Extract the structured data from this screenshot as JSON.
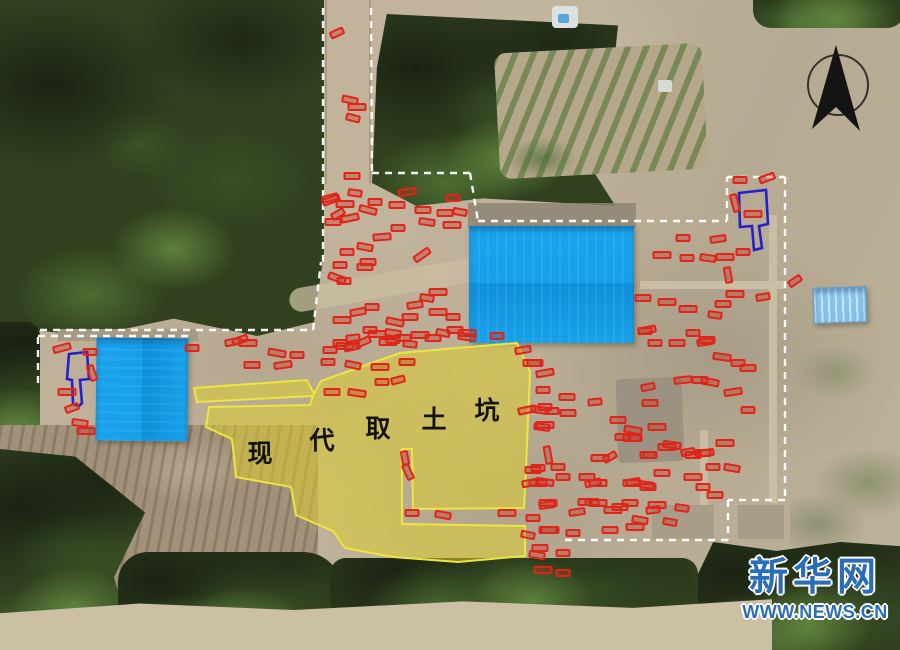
{
  "site": {
    "soil_pit_label": {
      "characters": [
        "现",
        "代",
        "取",
        "土",
        "坑"
      ],
      "positions": [
        [
          260,
          452
        ],
        [
          322,
          439
        ],
        [
          378,
          427
        ],
        [
          434,
          418
        ],
        [
          487,
          409
        ]
      ]
    },
    "pit_overlay": {
      "fill": "rgba(222,208,44,0.52)",
      "stroke": "#ece73f",
      "paths": [
        "M194,388 L307,380 L314,394 L321,381 L383,359 L400,353 L457,348 L517,343 L530,372 L526,468 L524,508 L413,509 L412,449 L402,449 L402,524 L525,526 L525,556 L458,562 L393,557 L345,548 L333,531 L296,515 L291,487 L236,477 L232,439 L206,427 L209,407 L310,405 L313,396 L197,402 Z"
      ]
    },
    "ramp_tombs": {
      "stroke": "#2420d0",
      "paths": [
        "M69,354 L87,352 L89,379 L80,380 L82,403 L79,406 L73,404 L72,380 L67,379 Z",
        "M739,193 L766,190 L768,224 L759,226 L762,248 L754,250 L752,226 L740,227 Z"
      ]
    },
    "boundaries": {
      "stroke": "#ffffff",
      "dash": "7 6",
      "segments": [
        [
          [
            323,
            8
          ],
          [
            323,
            262
          ]
        ],
        [
          [
            371,
            8
          ],
          [
            372,
            173
          ]
        ],
        [
          [
            372,
            173
          ],
          [
            470,
            173
          ]
        ],
        [
          [
            470,
            173
          ],
          [
            478,
            221
          ]
        ],
        [
          [
            478,
            221
          ],
          [
            727,
            221
          ]
        ],
        [
          [
            727,
            221
          ],
          [
            727,
            177
          ]
        ],
        [
          [
            727,
            177
          ],
          [
            785,
            177
          ]
        ],
        [
          [
            785,
            177
          ],
          [
            785,
            500
          ]
        ],
        [
          [
            785,
            500
          ],
          [
            728,
            500
          ]
        ],
        [
          [
            728,
            500
          ],
          [
            728,
            540
          ]
        ],
        [
          [
            728,
            540
          ],
          [
            560,
            540
          ]
        ],
        [
          [
            40,
            330
          ],
          [
            313,
            330
          ]
        ],
        [
          [
            313,
            330
          ],
          [
            321,
            262
          ]
        ],
        [
          [
            38,
            336
          ],
          [
            190,
            336
          ]
        ],
        [
          [
            38,
            337
          ],
          [
            38,
            385
          ]
        ]
      ]
    },
    "compass": {
      "circle": [
        838,
        85,
        30
      ],
      "arrow": "836,45 860,131 836,107 812,129",
      "color": "#141414"
    },
    "tomb_markers": {
      "color": "#e2231a",
      "default_w": 17,
      "default_h": 8,
      "items": [
        [
          337,
          33,
          -25
        ],
        [
          350,
          100,
          12
        ],
        [
          357,
          107,
          0
        ],
        [
          353,
          118,
          14
        ],
        [
          352,
          176,
          0
        ],
        [
          331,
          200,
          -20
        ],
        [
          355,
          193,
          8
        ],
        [
          330,
          198,
          -15
        ],
        [
          345,
          204,
          0
        ],
        [
          375,
          202,
          0
        ],
        [
          397,
          205,
          0
        ],
        [
          407,
          192,
          -10
        ],
        [
          453,
          198,
          0
        ],
        [
          423,
          210,
          0
        ],
        [
          368,
          210,
          15
        ],
        [
          338,
          214,
          -30
        ],
        [
          333,
          222,
          0
        ],
        [
          350,
          218,
          -12
        ],
        [
          398,
          228,
          0
        ],
        [
          427,
          222,
          8
        ],
        [
          452,
          225,
          0
        ],
        [
          460,
          212,
          10
        ],
        [
          445,
          213,
          0
        ],
        [
          382,
          237,
          -5
        ],
        [
          347,
          252,
          0
        ],
        [
          365,
          247,
          10
        ],
        [
          422,
          255,
          -35
        ],
        [
          340,
          265,
          0
        ],
        [
          368,
          262,
          0
        ],
        [
          337,
          278,
          20
        ],
        [
          344,
          281,
          0
        ],
        [
          365,
          267,
          0
        ],
        [
          438,
          292,
          0
        ],
        [
          427,
          298,
          10
        ],
        [
          415,
          305,
          -8
        ],
        [
          438,
          312,
          0
        ],
        [
          453,
          317,
          0
        ],
        [
          410,
          317,
          0
        ],
        [
          395,
          322,
          12
        ],
        [
          372,
          307,
          0
        ],
        [
          358,
          312,
          -10
        ],
        [
          342,
          320,
          0
        ],
        [
          370,
          330,
          0
        ],
        [
          393,
          333,
          8
        ],
        [
          377,
          334,
          0
        ],
        [
          353,
          338,
          -6
        ],
        [
          403,
          338,
          0
        ],
        [
          420,
          335,
          0
        ],
        [
          443,
          333,
          10
        ],
        [
          455,
          330,
          0
        ],
        [
          467,
          333,
          0
        ],
        [
          340,
          343,
          0
        ],
        [
          352,
          347,
          -12
        ],
        [
          388,
          342,
          0
        ],
        [
          410,
          344,
          6
        ],
        [
          240,
          340,
          -18
        ],
        [
          277,
          353,
          10
        ],
        [
          297,
          355,
          0
        ],
        [
          252,
          365,
          0
        ],
        [
          283,
          365,
          -8
        ],
        [
          330,
          350,
          0
        ],
        [
          363,
          342,
          -25
        ],
        [
          345,
          346,
          0
        ],
        [
          393,
          340,
          0
        ],
        [
          433,
          338,
          0
        ],
        [
          467,
          337,
          8
        ],
        [
          497,
          336,
          0
        ],
        [
          523,
          350,
          -10
        ],
        [
          532,
          363,
          0
        ],
        [
          328,
          362,
          0
        ],
        [
          353,
          365,
          12
        ],
        [
          380,
          367,
          0
        ],
        [
          398,
          380,
          -15
        ],
        [
          332,
          392,
          0
        ],
        [
          357,
          393,
          8
        ],
        [
          382,
          382,
          0
        ],
        [
          407,
          362,
          0
        ],
        [
          62,
          348,
          -15
        ],
        [
          90,
          352,
          0
        ],
        [
          92,
          373,
          70
        ],
        [
          67,
          392,
          0
        ],
        [
          72,
          408,
          -20
        ],
        [
          80,
          423,
          8
        ],
        [
          86,
          431,
          0
        ],
        [
          192,
          348,
          0
        ],
        [
          233,
          342,
          -10
        ],
        [
          248,
          343,
          0
        ],
        [
          405,
          458,
          80
        ],
        [
          408,
          472,
          65
        ],
        [
          527,
          410,
          -12
        ],
        [
          545,
          407,
          0
        ],
        [
          542,
          427,
          8
        ],
        [
          548,
          455,
          80
        ],
        [
          538,
          468,
          0
        ],
        [
          530,
          483,
          -10
        ],
        [
          548,
          503,
          0
        ],
        [
          528,
          535,
          12
        ],
        [
          540,
          548,
          0
        ],
        [
          550,
          530,
          0
        ],
        [
          412,
          513,
          0
        ],
        [
          443,
          515,
          10
        ],
        [
          507,
          513,
          0
        ],
        [
          533,
          518,
          0
        ],
        [
          547,
          505,
          -8
        ],
        [
          538,
          483,
          0
        ],
        [
          563,
          553,
          0
        ],
        [
          537,
          555,
          10
        ],
        [
          543,
          570,
          0
        ],
        [
          563,
          573,
          0
        ],
        [
          593,
          483,
          -12
        ],
        [
          598,
          503,
          0
        ],
        [
          585,
          502,
          0
        ],
        [
          535,
          363,
          0
        ],
        [
          545,
          373,
          -10
        ],
        [
          543,
          390,
          0
        ],
        [
          567,
          397,
          0
        ],
        [
          540,
          410,
          8
        ],
        [
          552,
          411,
          0
        ],
        [
          568,
          413,
          0
        ],
        [
          545,
          425,
          0
        ],
        [
          595,
          402,
          -6
        ],
        [
          618,
          420,
          0
        ],
        [
          633,
          430,
          10
        ],
        [
          635,
          438,
          0
        ],
        [
          623,
          437,
          0
        ],
        [
          657,
          427,
          0
        ],
        [
          648,
          387,
          -12
        ],
        [
          650,
          403,
          0
        ],
        [
          672,
          445,
          8
        ],
        [
          650,
          455,
          0
        ],
        [
          693,
          455,
          0
        ],
        [
          705,
          453,
          -8
        ],
        [
          713,
          467,
          0
        ],
        [
          732,
          468,
          10
        ],
        [
          693,
          477,
          0
        ],
        [
          703,
          487,
          0
        ],
        [
          715,
          495,
          0
        ],
        [
          647,
          330,
          -10
        ],
        [
          693,
          333,
          0
        ],
        [
          707,
          340,
          0
        ],
        [
          722,
          357,
          8
        ],
        [
          738,
          363,
          0
        ],
        [
          748,
          368,
          0
        ],
        [
          733,
          392,
          -8
        ],
        [
          748,
          410,
          0
        ],
        [
          700,
          380,
          0
        ],
        [
          710,
          382,
          10
        ],
        [
          655,
          343,
          0
        ],
        [
          677,
          343,
          0
        ],
        [
          683,
          380,
          -6
        ],
        [
          558,
          467,
          0
        ],
        [
          533,
          470,
          0
        ],
        [
          545,
          482,
          8
        ],
        [
          563,
          477,
          0
        ],
        [
          587,
          477,
          0
        ],
        [
          598,
          483,
          0
        ],
        [
          633,
          482,
          -10
        ],
        [
          648,
          487,
          0
        ],
        [
          657,
          505,
          0
        ],
        [
          682,
          508,
          8
        ],
        [
          630,
          503,
          0
        ],
        [
          613,
          510,
          0
        ],
        [
          592,
          502,
          0
        ],
        [
          577,
          512,
          -8
        ],
        [
          548,
          530,
          0
        ],
        [
          573,
          533,
          0
        ],
        [
          640,
          520,
          10
        ],
        [
          600,
          458,
          0
        ],
        [
          610,
          457,
          -30
        ],
        [
          648,
          455,
          0
        ],
        [
          632,
          483,
          0
        ],
        [
          647,
          485,
          8
        ],
        [
          662,
          473,
          0
        ],
        [
          667,
          447,
          0
        ],
        [
          688,
          452,
          -10
        ],
        [
          703,
          453,
          0
        ],
        [
          725,
          443,
          0
        ],
        [
          653,
          510,
          -8
        ],
        [
          620,
          507,
          0
        ],
        [
          635,
          527,
          0
        ],
        [
          670,
          522,
          10
        ],
        [
          610,
          530,
          0
        ],
        [
          632,
          438,
          0
        ],
        [
          683,
          238,
          0
        ],
        [
          718,
          239,
          -8
        ],
        [
          662,
          255,
          0
        ],
        [
          687,
          258,
          0
        ],
        [
          708,
          258,
          8
        ],
        [
          725,
          257,
          0
        ],
        [
          743,
          252,
          0
        ],
        [
          728,
          275,
          80
        ],
        [
          735,
          294,
          0
        ],
        [
          763,
          297,
          -10
        ],
        [
          723,
          304,
          0
        ],
        [
          688,
          309,
          0
        ],
        [
          715,
          315,
          8
        ],
        [
          643,
          298,
          0
        ],
        [
          667,
          302,
          0
        ],
        [
          645,
          331,
          0
        ],
        [
          705,
          342,
          -8
        ],
        [
          753,
          214,
          0
        ],
        [
          740,
          180,
          0
        ],
        [
          767,
          178,
          -20
        ],
        [
          735,
          203,
          75
        ],
        [
          795,
          281,
          -35
        ]
      ]
    }
  },
  "watermark": {
    "brand": "新华网",
    "url": "WWW.NEWS.CN",
    "color": "#2a6db8"
  }
}
